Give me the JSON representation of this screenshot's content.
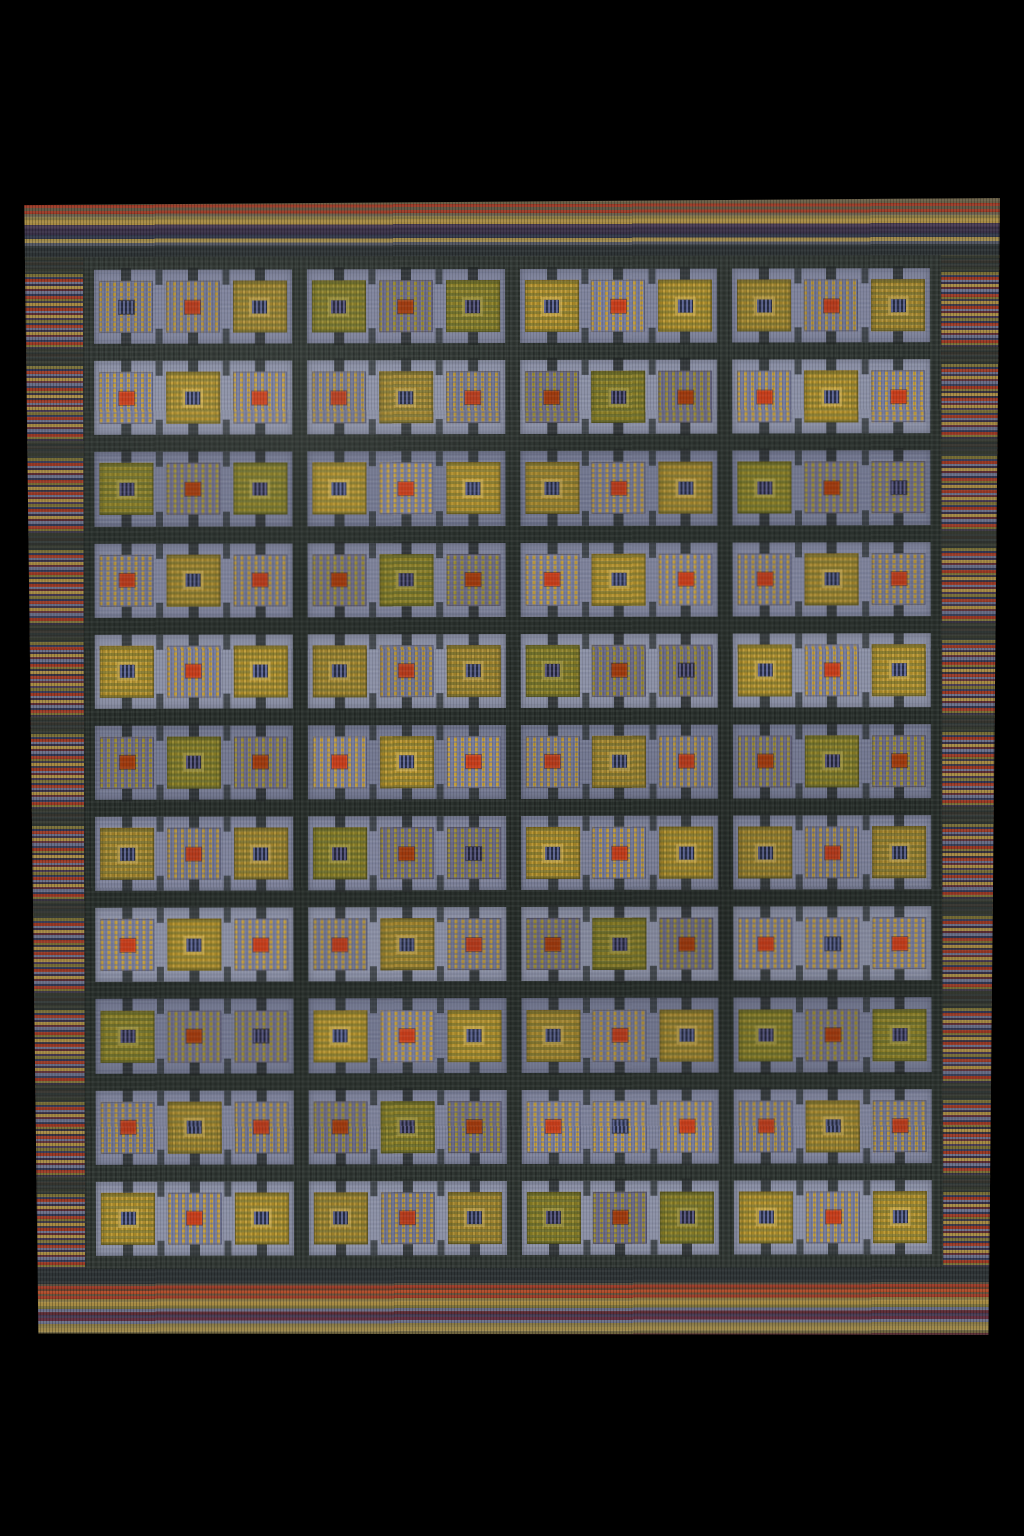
{
  "meta": {
    "description": "Photograph of a handwoven Scandinavian-style flat-weave wool kilim rug on a black background. Slate blue-purple field divided by a dark charcoal grid into 4 columns and 11 rows of panels; each panel holds three small gold/olive squares whose centers alternate between a red dot and a dark indigo striped motif. Variegated striped borders in red, gold, olive, plum and slate surround the field."
  },
  "canvas": {
    "width": 1024,
    "height": 1536,
    "background": "#000000"
  },
  "rug": {
    "left": 24,
    "top": 199,
    "width": 978,
    "height": 1138,
    "borders": {
      "top_height": 57,
      "bottom_height": 69,
      "side_width": 60
    },
    "field": {
      "rows": 11,
      "columns": 4,
      "squares_per_cell": 3,
      "center_pattern_odd_rows": [
        "grill",
        "red",
        "grill"
      ],
      "center_pattern_even_rows": [
        "red",
        "grill",
        "red"
      ]
    },
    "colors": {
      "field": "#7b8099",
      "field_light": "#888da3",
      "grid": "#2c332f",
      "grid_dark": "#242a28",
      "gold": "#9a7e2a",
      "gold_light": "#c1a14e",
      "olive": "#6f6d31",
      "hatch_gold": "#b3923c",
      "red_center": "#b23a1c",
      "grill_navy": "#262b40",
      "grill_stroke": "#59608a",
      "stripe_red": "#9c3a26",
      "stripe_gold": "#a78b44",
      "stripe_gold2": "#8a7a46",
      "stripe_olive": "#7a7038",
      "stripe_slate": "#6a6f88",
      "stripe_navy": "#343a56",
      "stripe_purple": "#473a52",
      "stripe_maroon": "#5f2f38",
      "stripe_plum": "#3a3148",
      "border_dark": "#2e3436"
    }
  }
}
